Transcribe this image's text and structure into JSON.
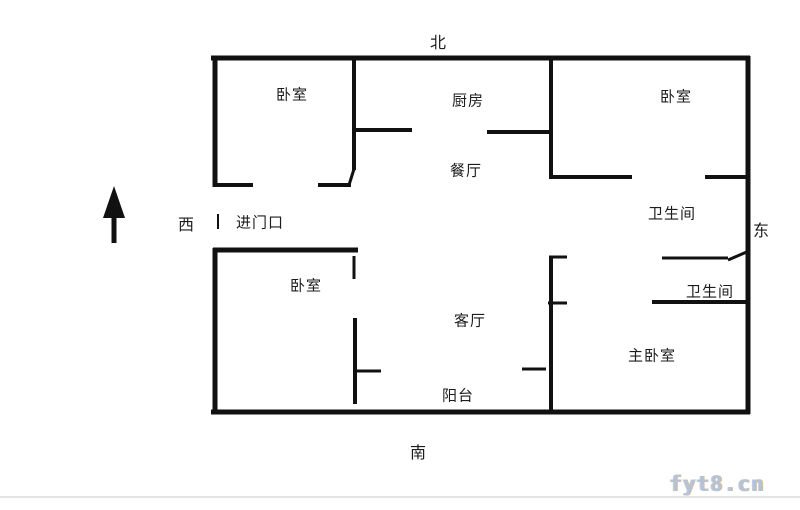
{
  "compass": {
    "north": "北",
    "south": "南",
    "west": "西",
    "east": "东"
  },
  "rooms": {
    "bedroom_nw": "卧室",
    "kitchen": "厨房",
    "dining": "餐厅",
    "bedroom_ne": "卧室",
    "bathroom_upper": "卫生间",
    "bathroom_lower": "卫生间",
    "entrance": "进门口",
    "bedroom_sw": "卧室",
    "living": "客厅",
    "master_bedroom": "主卧室",
    "balcony": "阳台"
  },
  "watermark": "fyt8.cn",
  "colors": {
    "wall": "#111111",
    "label_text": "#1c1c1c",
    "watermark_text": "#b6c2d5",
    "background": "#ffffff"
  }
}
